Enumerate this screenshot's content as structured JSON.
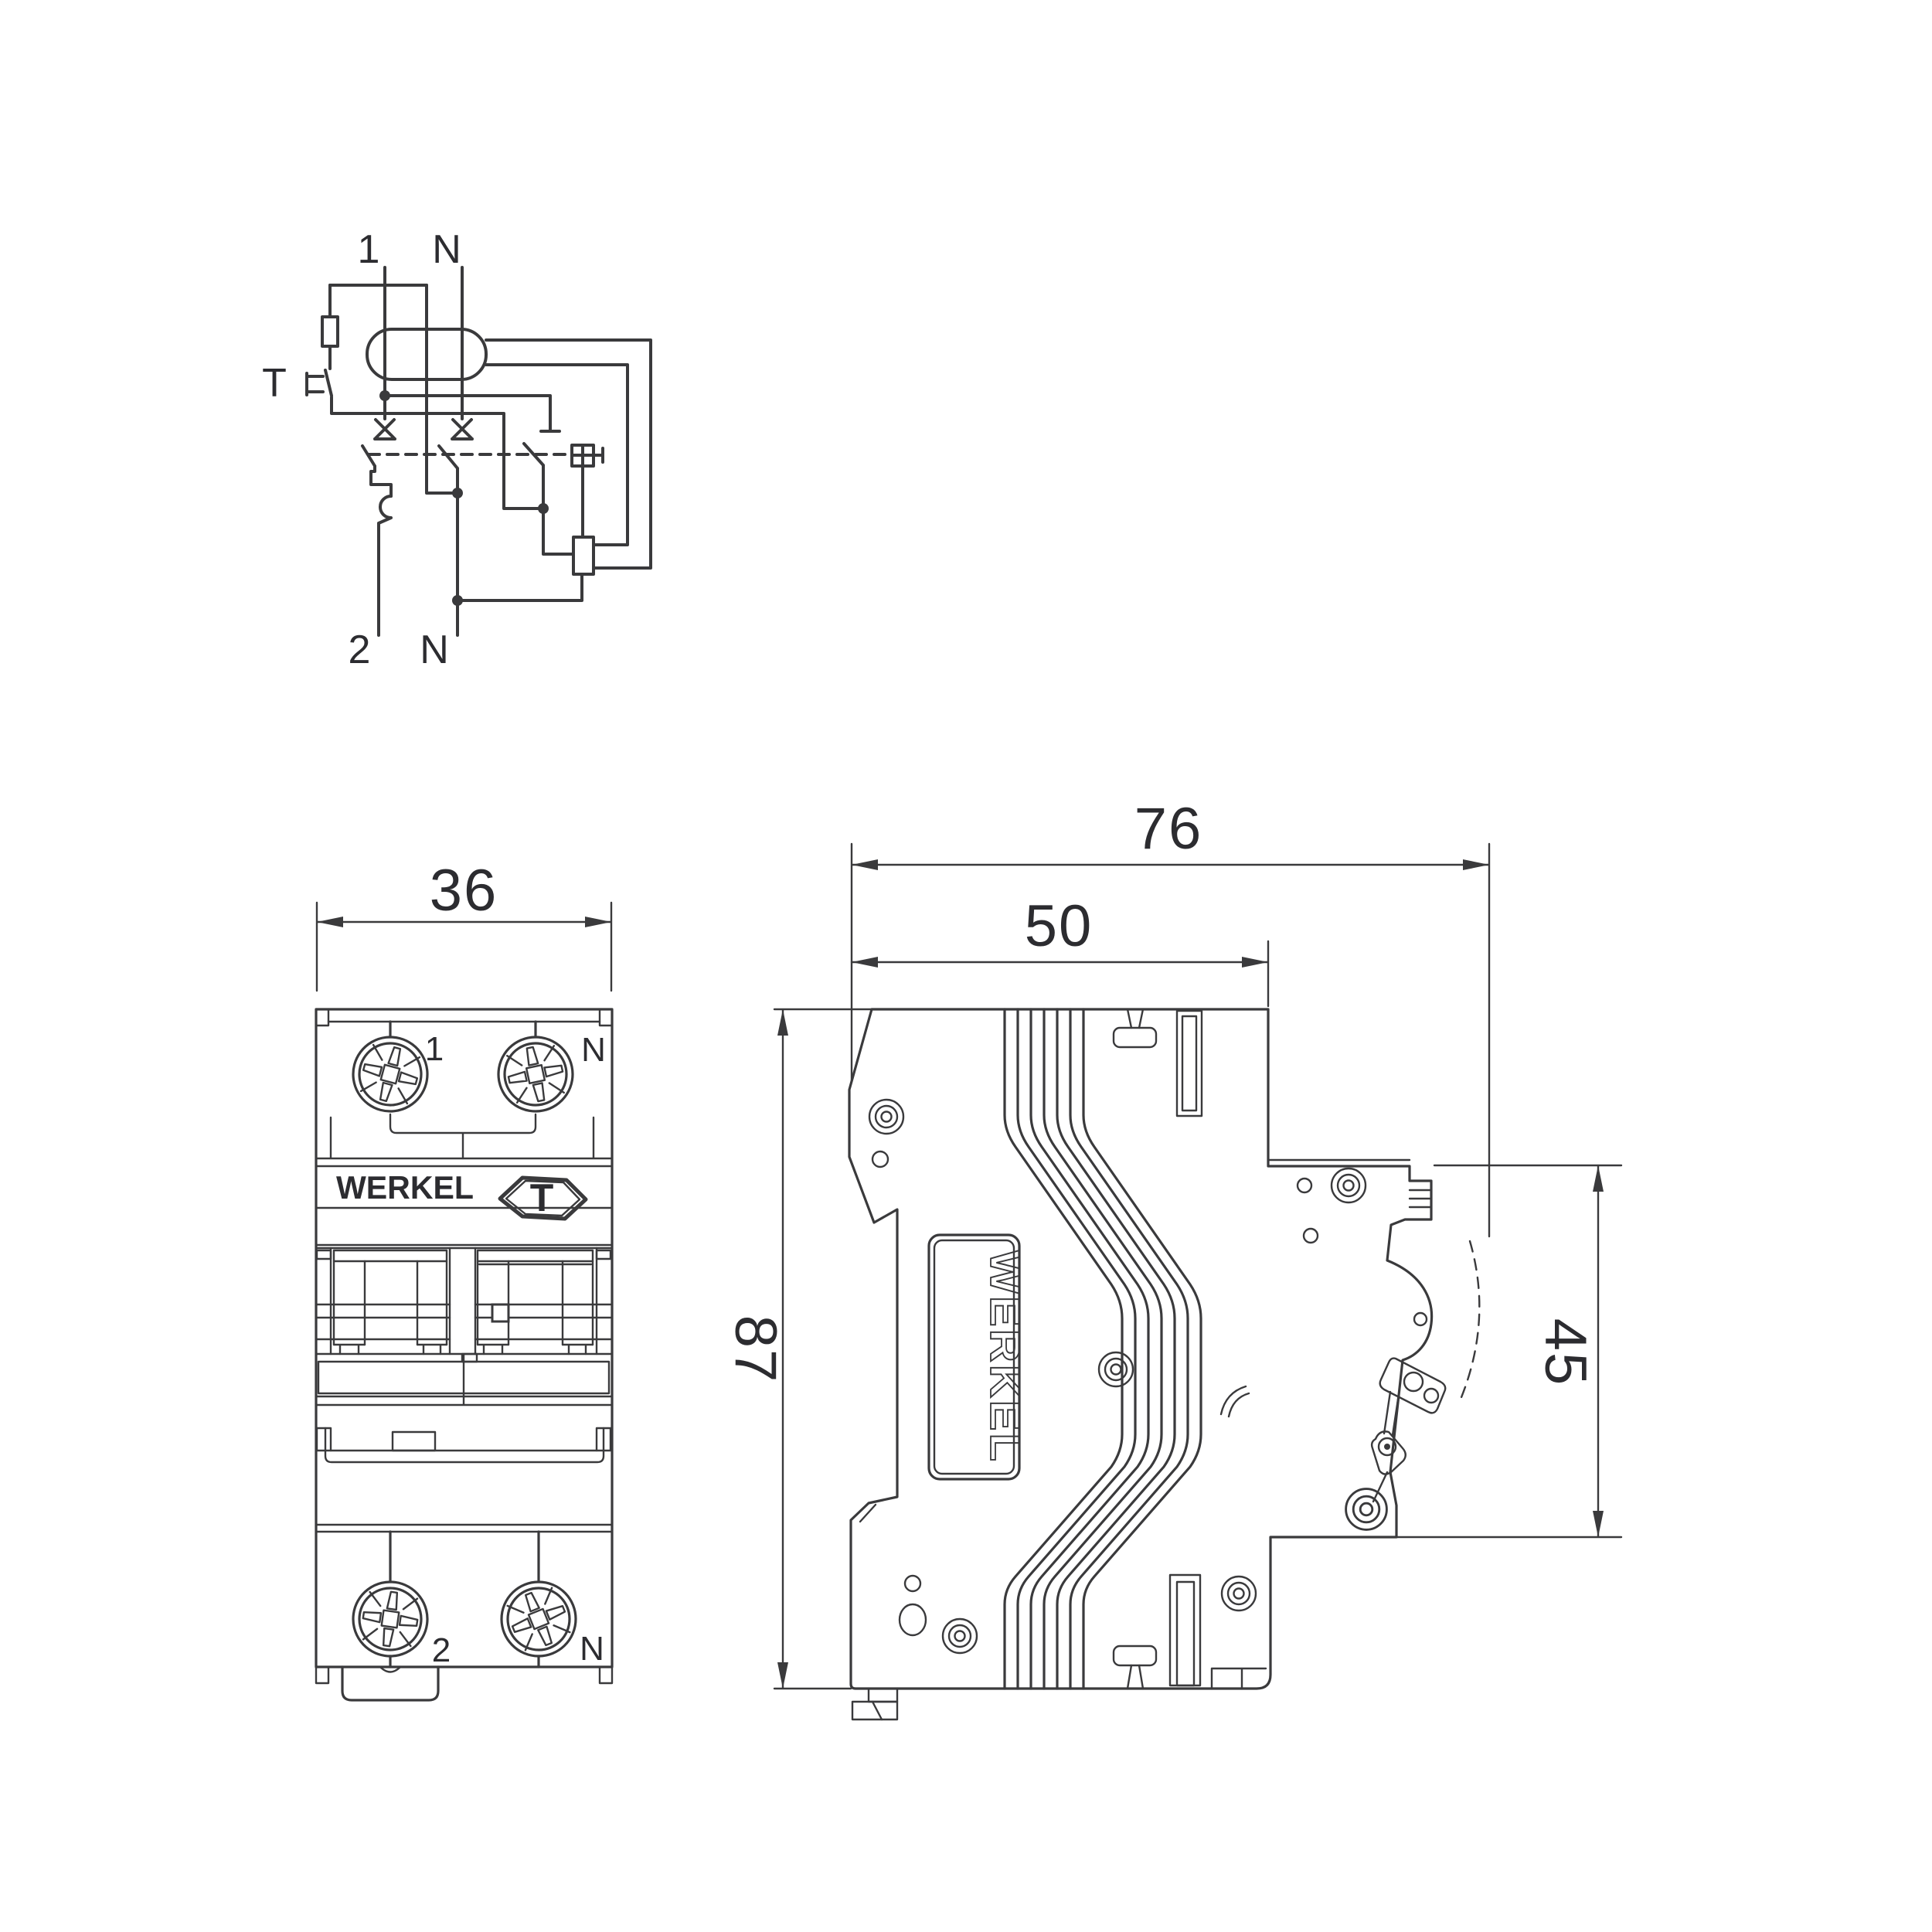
{
  "drawing": {
    "brand": "WERKEL",
    "subject": "din-rail-circuit-breaker",
    "views": {
      "top_left": "wiring-schematic",
      "bottom_left": "front-view",
      "right": "side-view"
    }
  },
  "schematic": {
    "input_phase_label": "1",
    "input_neutral_label": "N",
    "test_button_label": "T",
    "output_phase_label": "2",
    "output_neutral_label": "N"
  },
  "front_view": {
    "brand_label": "WERKEL",
    "test_button_label": "T",
    "terminal_top_left_label": "1",
    "terminal_top_right_label": "N",
    "terminal_bottom_left_label": "2",
    "terminal_bottom_right_label": "N"
  },
  "side_view": {
    "brand_label": "WERKEL"
  },
  "dimensions": {
    "front_width_mm": "36",
    "side_total_depth_mm": "76",
    "side_body_depth_mm": "50",
    "side_height_mm": "87",
    "side_din_section_mm": "45"
  },
  "colors": {
    "line": "#3a3a3c",
    "text": "#2c2c30",
    "background": "#ffffff"
  }
}
